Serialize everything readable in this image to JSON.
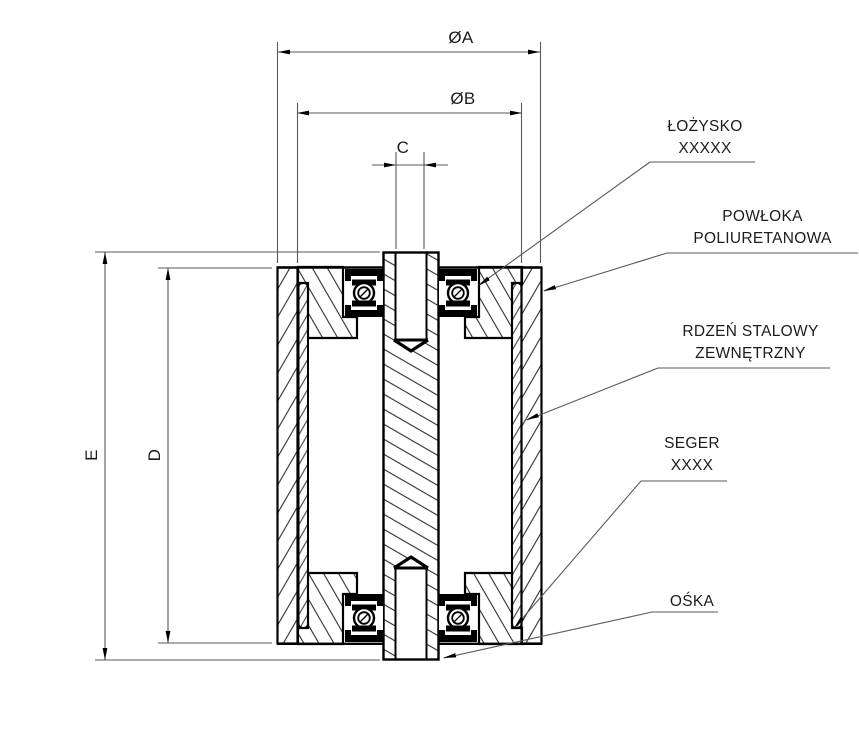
{
  "title": "roller-wheel-cross-section-drawing",
  "dim_labels": {
    "outer_diameter": "ØA",
    "core_diameter": "ØB",
    "bore": "C",
    "core_height": "D",
    "axle_length": "E"
  },
  "callouts": {
    "bearing": {
      "line1": "ŁOŻYSKO",
      "line2": "XXXXX"
    },
    "coating": {
      "line1": "POWŁOKA",
      "line2": "POLIURETANOWA"
    },
    "core": {
      "line1": "RDZEŃ STALOWY",
      "line2": "ZEWNĘTRZNY"
    },
    "circlip": {
      "line1": "SEGER",
      "line2": "XXXX"
    },
    "axle": {
      "line1": "OŚKA"
    }
  },
  "colors": {
    "outline": "#000000",
    "thin_line": "#5a5a5a",
    "underline": "#7a7a7a",
    "text": "#1c1c1c",
    "background": "#ffffff"
  }
}
